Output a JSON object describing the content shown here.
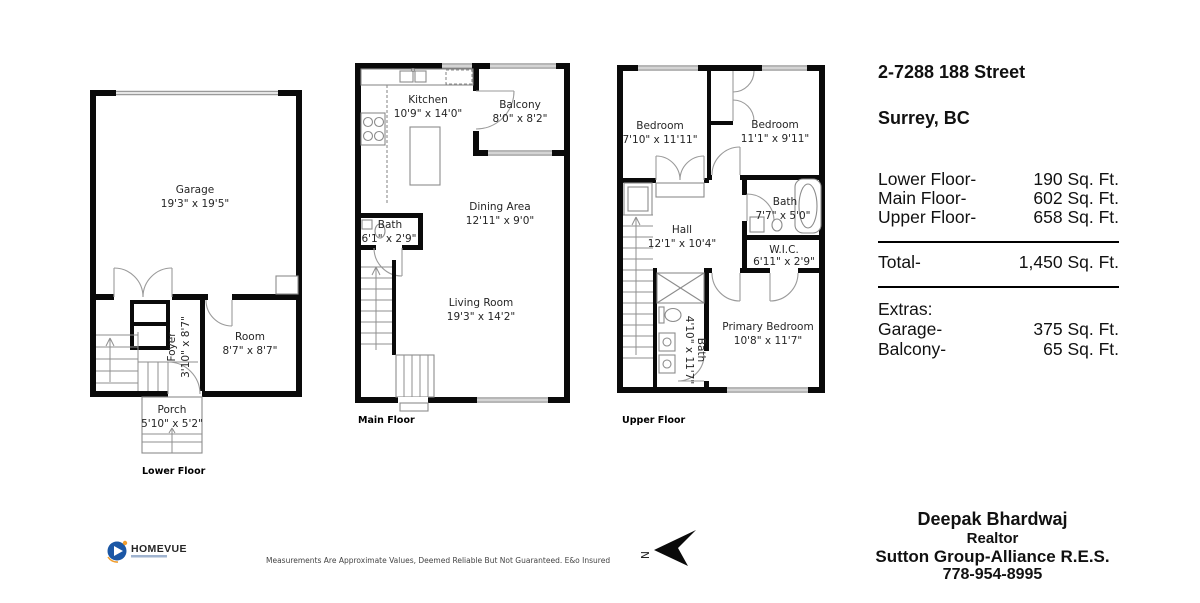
{
  "address": {
    "line1": "2-7288 188 Street",
    "line2": "Surrey, BC"
  },
  "areas": {
    "rows": [
      {
        "label": "Lower Floor-",
        "value": "190 Sq. Ft."
      },
      {
        "label": "Main Floor-",
        "value": "602 Sq. Ft."
      },
      {
        "label": "Upper Floor-",
        "value": "658 Sq. Ft."
      }
    ],
    "total": {
      "label": "Total-",
      "value": "1,450 Sq. Ft."
    },
    "extras_heading": "Extras:",
    "extras": [
      {
        "label": "Garage-",
        "value": "375 Sq. Ft."
      },
      {
        "label": "Balcony-",
        "value": "65 Sq. Ft."
      }
    ]
  },
  "plans": {
    "lower": {
      "label": "Lower Floor",
      "rooms": {
        "garage": {
          "name": "Garage",
          "dims": "19'3\" x 19'5\""
        },
        "foyer": {
          "name": "Foyer",
          "dims": "3'10\" x 8'7\""
        },
        "room": {
          "name": "Room",
          "dims": "8'7\" x 8'7\""
        },
        "porch": {
          "name": "Porch",
          "dims": "5'10\" x 5'2\""
        }
      }
    },
    "main": {
      "label": "Main Floor",
      "rooms": {
        "kitchen": {
          "name": "Kitchen",
          "dims": "10'9\" x 14'0\""
        },
        "balcony": {
          "name": "Balcony",
          "dims": "8'0\" x 8'2\""
        },
        "dining": {
          "name": "Dining Area",
          "dims": "12'11\" x 9'0\""
        },
        "bath": {
          "name": "Bath",
          "dims": "6'1\" x 2'9\""
        },
        "living": {
          "name": "Living Room",
          "dims": "19'3\" x 14'2\""
        }
      }
    },
    "upper": {
      "label": "Upper Floor",
      "rooms": {
        "bedroom1": {
          "name": "Bedroom",
          "dims": "7'10\" x 11'11\""
        },
        "bedroom2": {
          "name": "Bedroom",
          "dims": "11'1\" x 9'11\""
        },
        "bath1": {
          "name": "Bath",
          "dims": "7'7\" x 5'0\""
        },
        "hall": {
          "name": "Hall",
          "dims": "12'1\" x 10'4\""
        },
        "wic": {
          "name": "W.I.C.",
          "dims": "6'11\" x 2'9\""
        },
        "bath2": {
          "name": "Bath",
          "dims": "4'10\" x 11'7\""
        },
        "primary": {
          "name": "Primary Bedroom",
          "dims": "10'8\" x 11'7\""
        }
      }
    }
  },
  "footer": {
    "logo_text": "HOMEVUE",
    "disclaimer": "Measurements Are Approximate Values, Deemed Reliable But Not Guaranteed. E&o Insured",
    "compass_label": "N"
  },
  "realtor": {
    "name": "Deepak Bhardwaj",
    "title": "Realtor",
    "company": "Sutton Group-Alliance R.E.S.",
    "phone": "778-954-8995"
  },
  "colors": {
    "wall": "#0a0a0a",
    "logo_blue": "#1b57a5",
    "logo_orange": "#f09d2e"
  }
}
